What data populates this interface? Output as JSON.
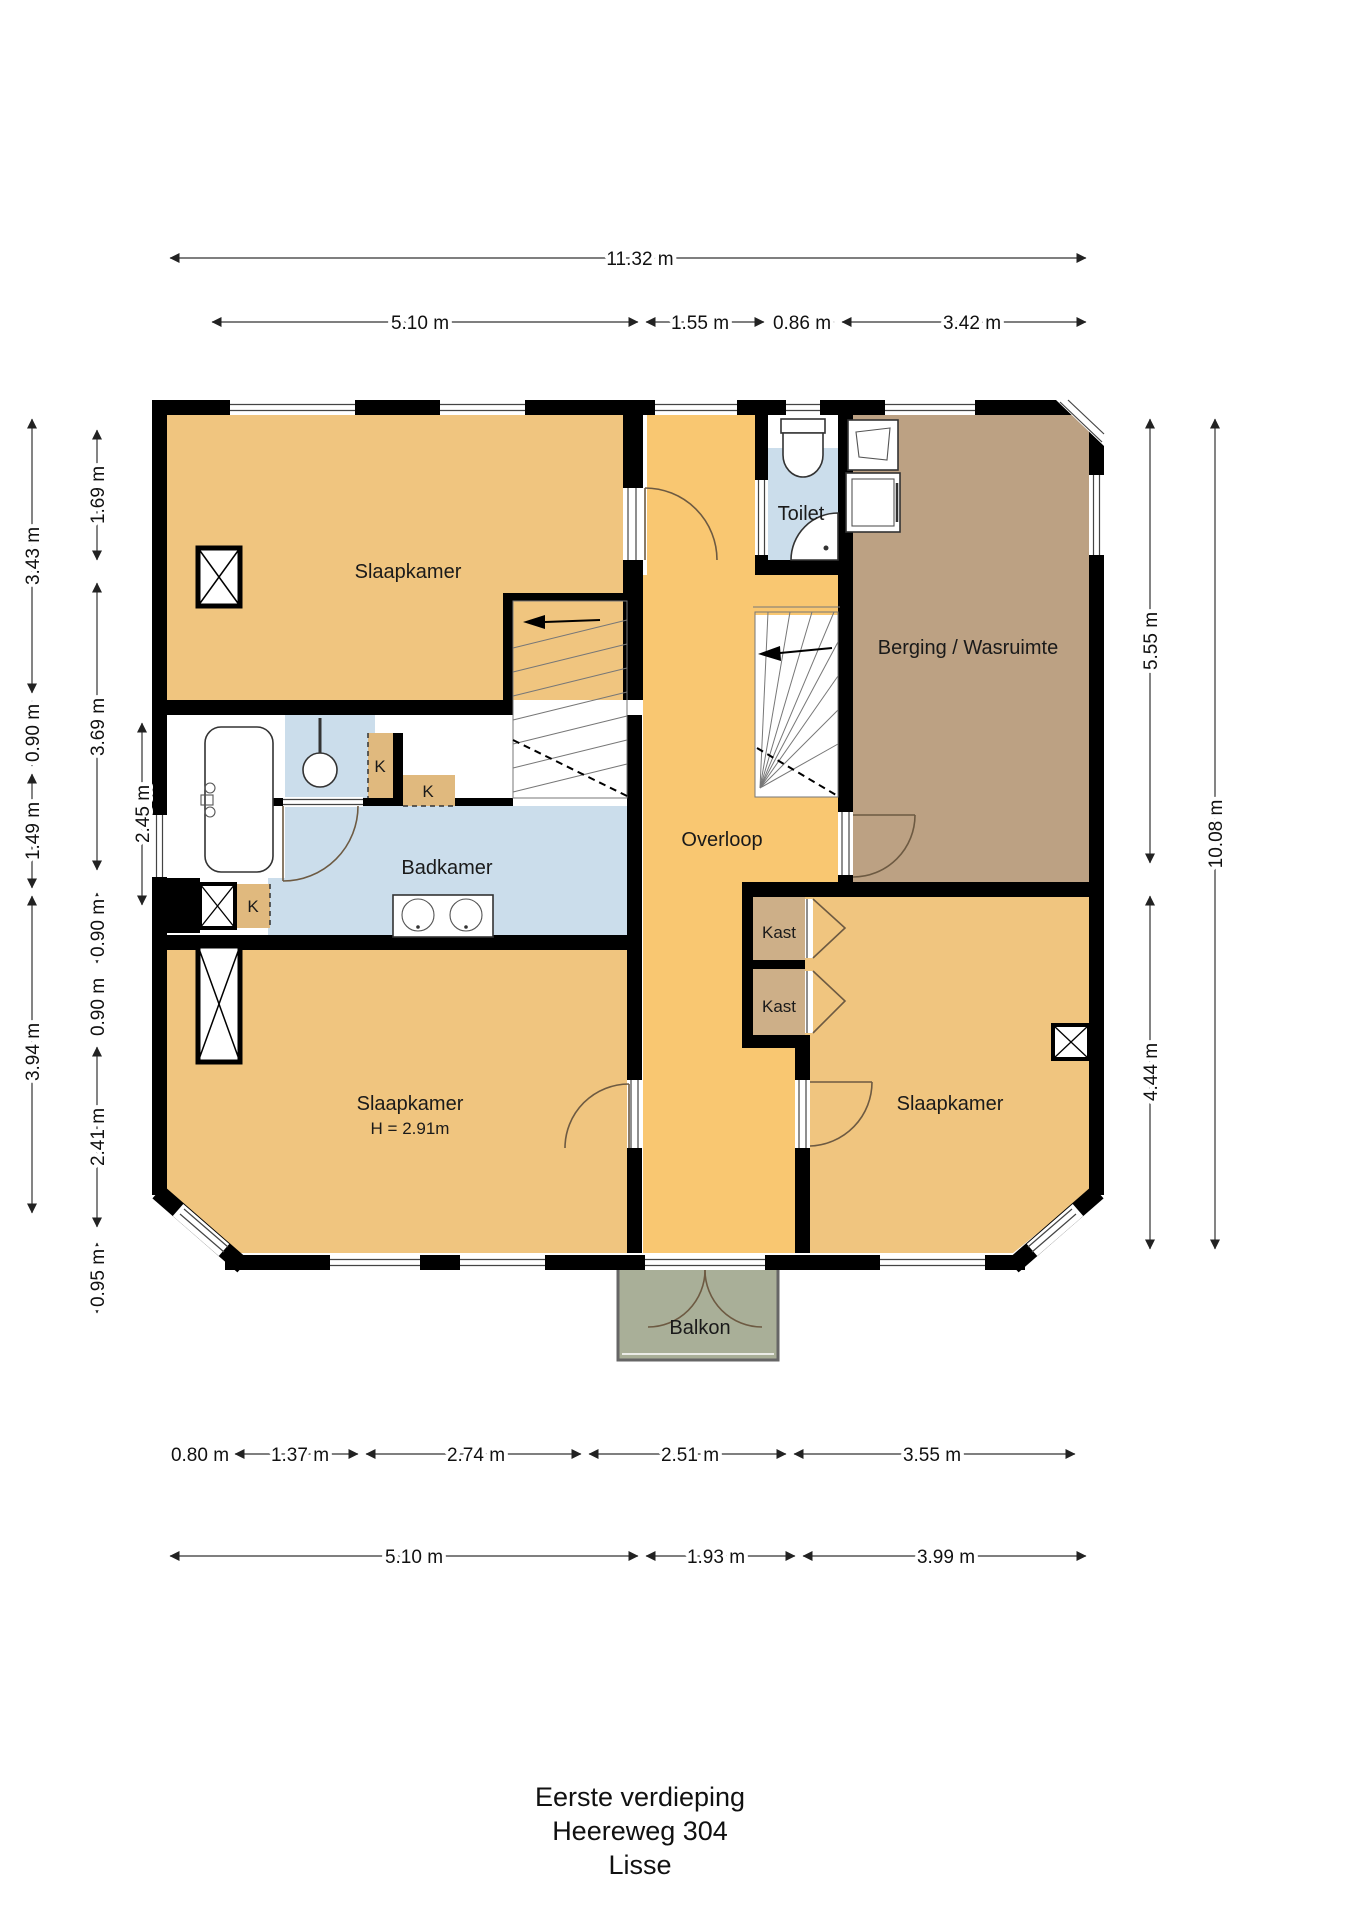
{
  "title": {
    "line1": "Eerste verdieping",
    "line2": "Heereweg 304",
    "line3": "Lisse"
  },
  "rooms": {
    "slaapkamer_top": {
      "label": "Slaapkamer"
    },
    "toilet": {
      "label": "Toilet"
    },
    "berging": {
      "label": "Berging / Wasruimte"
    },
    "badkamer": {
      "label": "Badkamer"
    },
    "overloop": {
      "label": "Overloop"
    },
    "kast_top": {
      "label": "Kast"
    },
    "kast_bottom": {
      "label": "Kast"
    },
    "slaapkamer_left": {
      "label": "Slaapkamer",
      "height_note": "H = 2.91m"
    },
    "slaapkamer_right": {
      "label": "Slaapkamer"
    },
    "balkon": {
      "label": "Balkon"
    },
    "closet_k1": {
      "label": "K"
    },
    "closet_k2": {
      "label": "K"
    },
    "closet_k3": {
      "label": "K"
    }
  },
  "dims": {
    "top_total": "11.32 m",
    "top": [
      "5.10 m",
      "1.55 m",
      "0.86 m",
      "3.42 m"
    ],
    "bottom_upper": [
      "0.80 m",
      "1.37 m",
      "2.74 m",
      "2.51 m",
      "3.55 m"
    ],
    "bottom_lower": [
      "5.10 m",
      "1.93 m",
      "3.99 m"
    ],
    "left_outer": [
      "3.43 m",
      "0.90 m",
      "1.49 m",
      "3.94 m"
    ],
    "left_inner": [
      "1.69 m",
      "3.69 m",
      "0.90 m",
      "0.90 m",
      "2.41 m",
      "0.95 m"
    ],
    "left_inner2": [
      "2.45 m"
    ],
    "right_inner": [
      "5.55 m",
      "4.44 m"
    ],
    "right_outer": [
      "10.08 m"
    ]
  },
  "colors": {
    "wall": "#000000",
    "bedroom": "#F0C57F",
    "overloop": "#F9C771",
    "berging": "#BCA183",
    "bath": "#CBDDEB",
    "kast": "#CDAF88",
    "kcloset": "#E0B97E",
    "balkon": "#A9AF98"
  }
}
